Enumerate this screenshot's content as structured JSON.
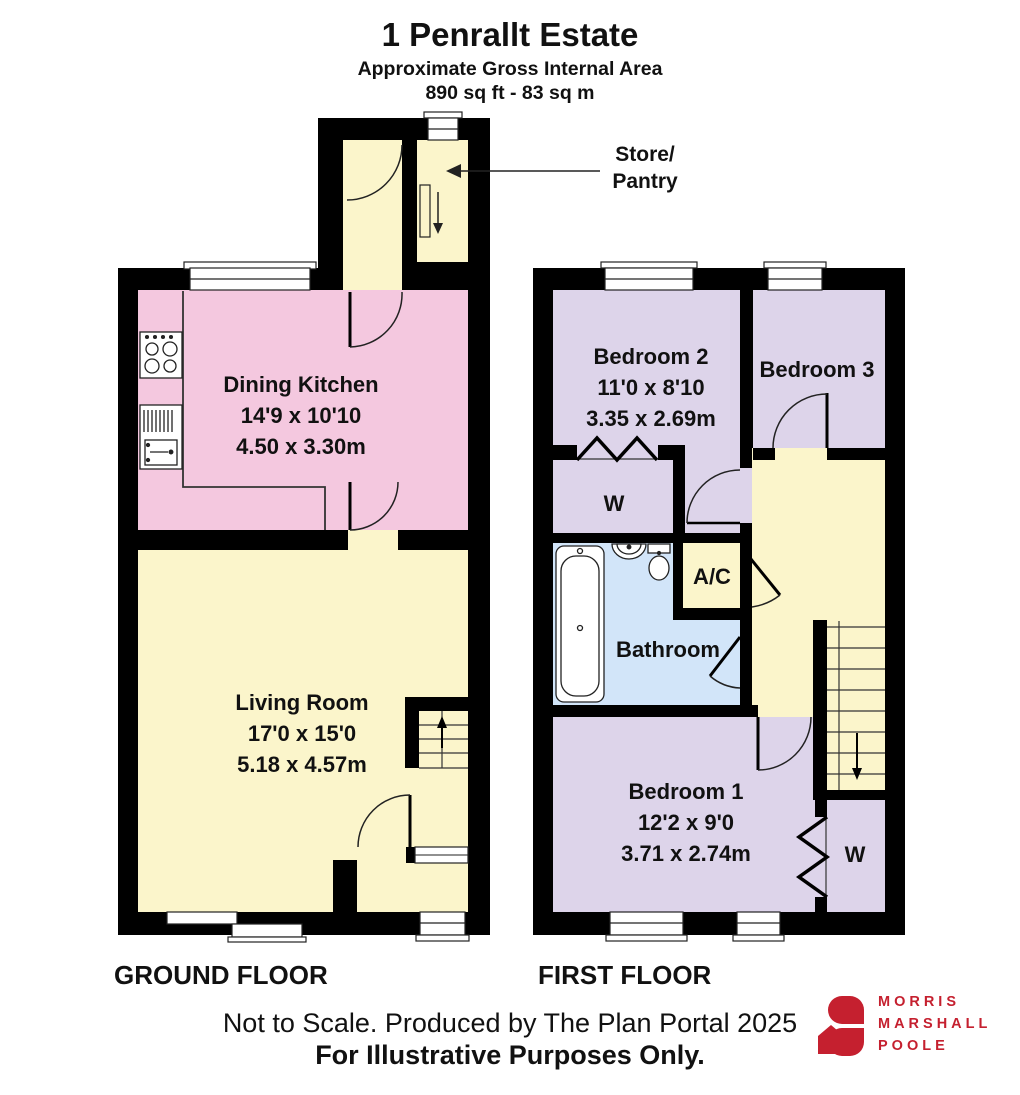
{
  "header": {
    "title": "1 Penrallt Estate",
    "subtitle": "Approximate Gross Internal Area",
    "area": "890 sq ft - 83 sq m"
  },
  "floors": {
    "ground": {
      "label": "GROUND FLOOR",
      "rooms": {
        "dining_kitchen": {
          "name": "Dining Kitchen",
          "size_ft": "14'9 x 10'10",
          "size_m": "4.50 x 3.30m"
        },
        "living_room": {
          "name": "Living Room",
          "size_ft": "17'0 x 15'0",
          "size_m": "5.18 x 4.57m"
        },
        "store_pantry": {
          "line1": "Store/",
          "line2": "Pantry"
        }
      }
    },
    "first": {
      "label": "FIRST FLOOR",
      "rooms": {
        "bedroom_2": {
          "name": "Bedroom 2",
          "size_ft": "11'0 x 8'10",
          "size_m": "3.35 x 2.69m"
        },
        "bedroom_3": {
          "name": "Bedroom 3"
        },
        "bedroom_1": {
          "name": "Bedroom 1",
          "size_ft": "12'2 x 9'0",
          "size_m": "3.71 x 2.74m"
        },
        "bathroom": {
          "name": "Bathroom"
        },
        "ac": {
          "name": "A/C"
        },
        "wardrobe_bedroom2": {
          "name": "W"
        },
        "wardrobe_bedroom1": {
          "name": "W"
        }
      }
    }
  },
  "footer": {
    "line1": "Not to Scale. Produced by The Plan Portal 2025",
    "line2": "For Illustrative Purposes Only."
  },
  "logo": {
    "line1": "MORRIS",
    "line2": "MARSHALL",
    "line3": "POOLE"
  },
  "colors": {
    "wall": "#000000",
    "yellow": "#FBF5CB",
    "pink": "#F4C8DF",
    "lavender": "#DDD4EA",
    "blue": "#D2E5F9",
    "logo_red": "#C5202F",
    "window": "#FFFFFF"
  }
}
